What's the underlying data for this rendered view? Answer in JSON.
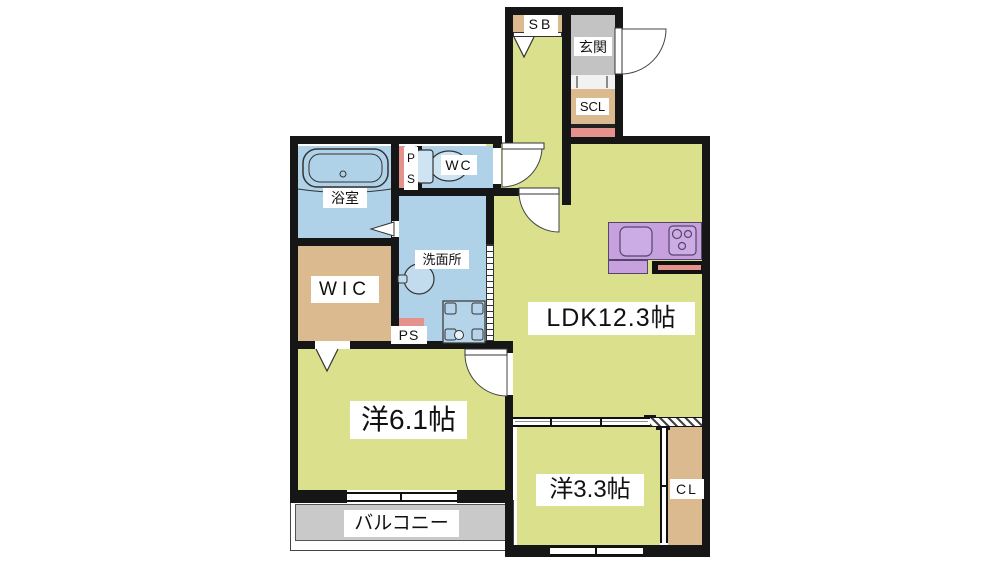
{
  "title": "1LDK+2 apartment floor plan",
  "colors": {
    "room_yellow": "#dbe08d",
    "wet_area_blue": "#afd2e8",
    "closet_tan": "#dcba90",
    "genkan_gray": "#c3c3c3",
    "balcony_gray": "#c9c9c9",
    "kitchen_purple": "#c6a1dd",
    "accent_pink": "#e5928c",
    "wall_black": "#161616"
  },
  "rooms": {
    "sb": {
      "label": "SB"
    },
    "genkan": {
      "label": "玄関"
    },
    "scl": {
      "label": "SCL"
    },
    "bathroom": {
      "label": "浴室"
    },
    "ps_upper": {
      "p": "P",
      "s": "S"
    },
    "wc": {
      "label": "WC"
    },
    "washroom": {
      "label": "洗面所"
    },
    "wic": {
      "label": "WIC"
    },
    "ps_lower": {
      "label": "PS"
    },
    "ldk": {
      "label": "LDK12.3帖"
    },
    "bedroom_61": {
      "label": "洋6.1帖"
    },
    "bedroom_33": {
      "label": "洋3.3帖"
    },
    "cl": {
      "label": "CL"
    },
    "balcony": {
      "label": "バルコニー"
    }
  }
}
